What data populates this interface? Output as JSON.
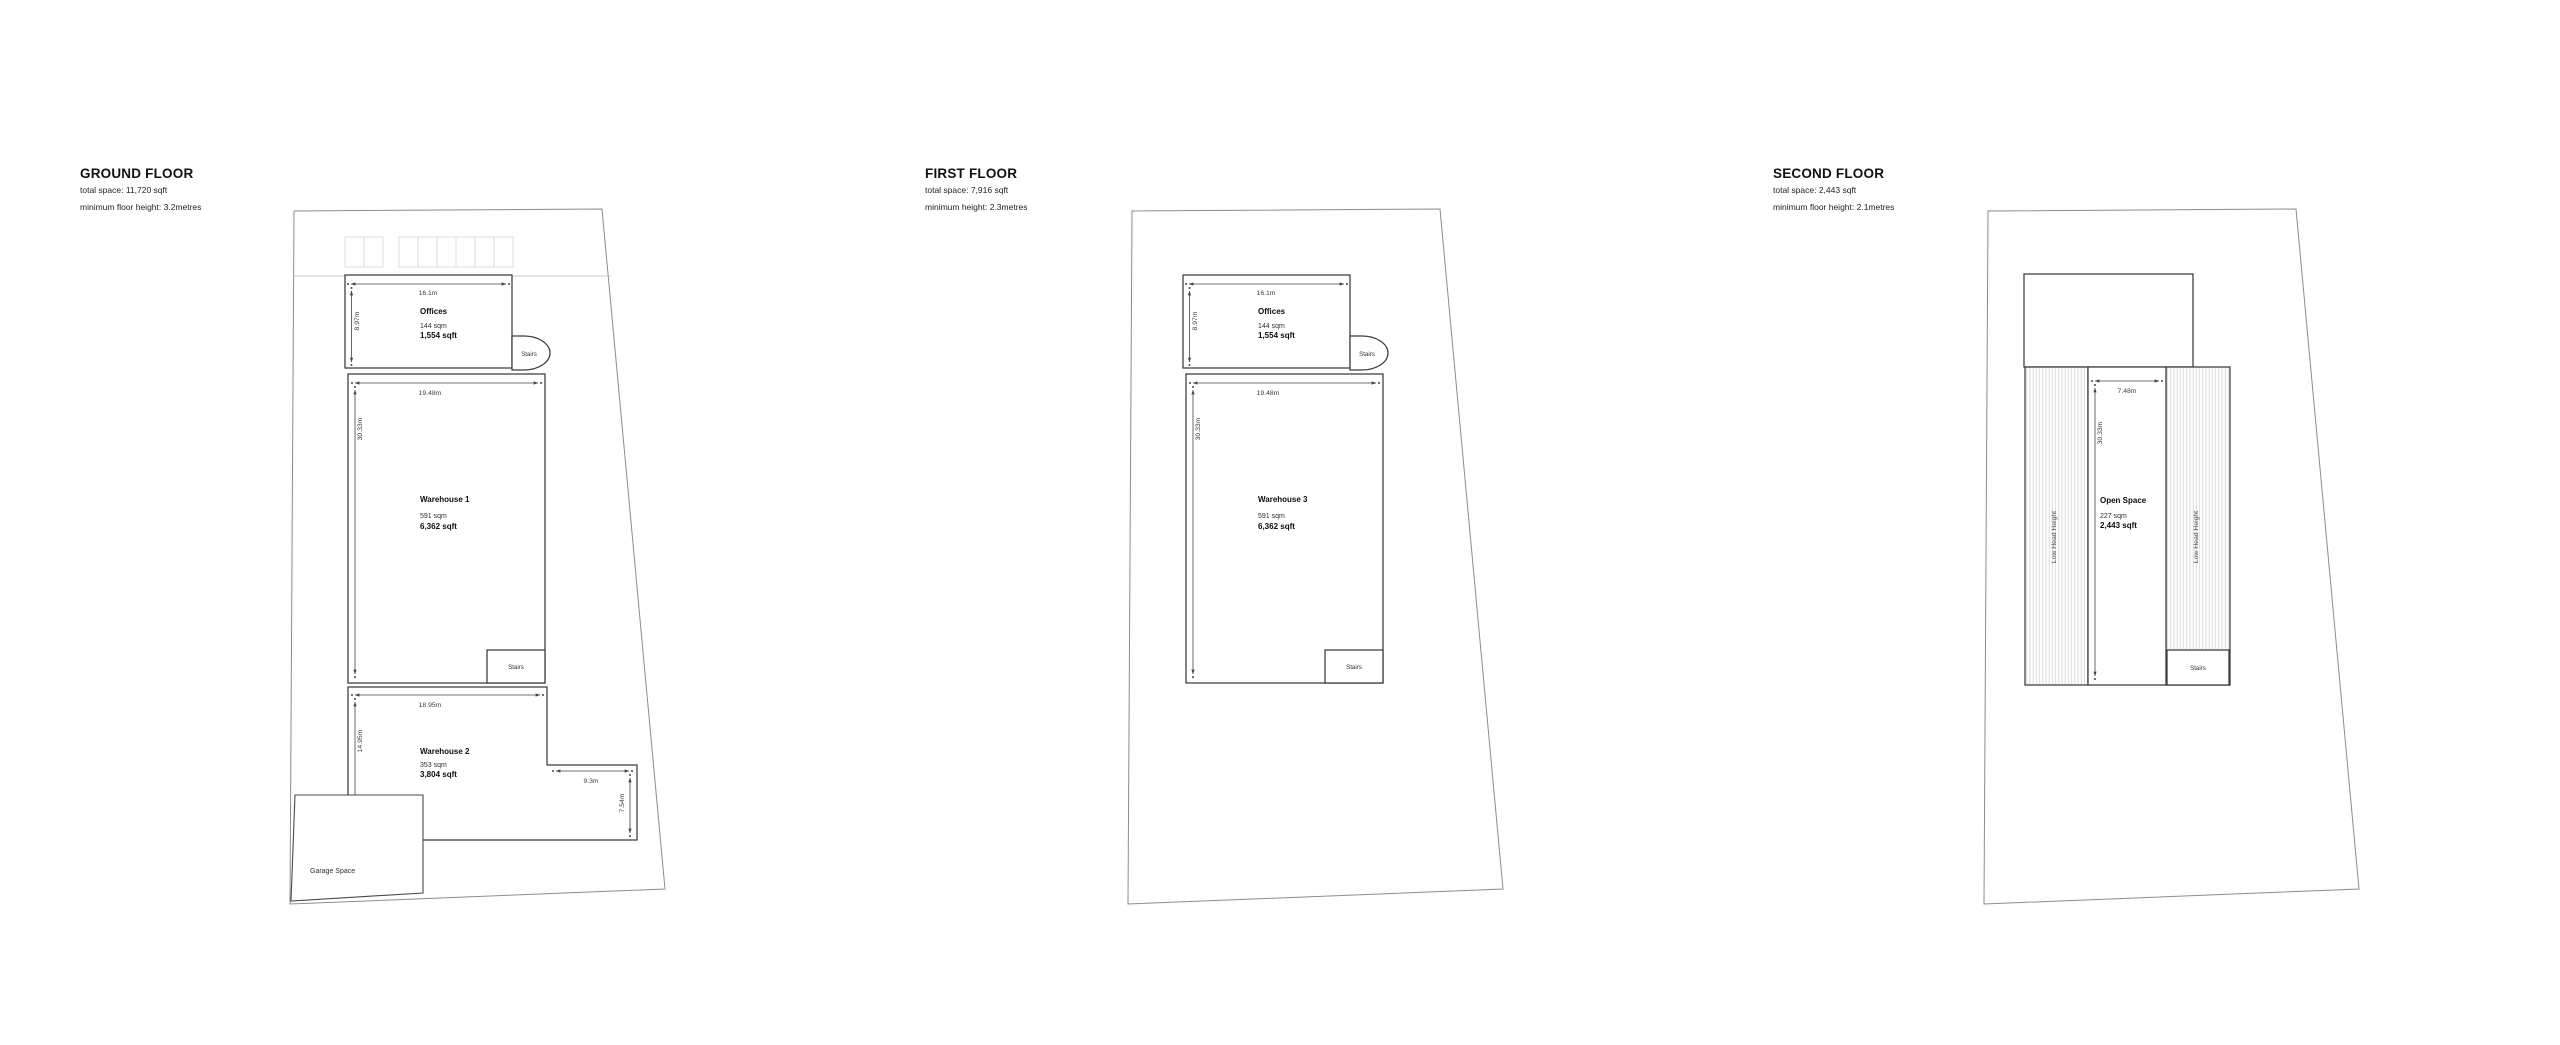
{
  "floors": [
    {
      "title": "GROUND FLOOR",
      "total_space": "total space: 11,720 sqft",
      "min_height": "minimum floor height: 3.2metres",
      "offices": {
        "name": "Offices",
        "sqm": "144 sqm",
        "sqft": "1,554 sqft",
        "width": "16.1m",
        "depth": "8.97m"
      },
      "warehouse1": {
        "name": "Warehouse 1",
        "sqm": "591 sqm",
        "sqft": "6,362 sqft",
        "width": "19.48m",
        "depth": "30.33m"
      },
      "warehouse2": {
        "name": "Warehouse 2",
        "sqm": "353 sqm",
        "sqft": "3,804 sqft",
        "width": "18.95m",
        "depth": "14.95m",
        "notch_width": "9.3m",
        "notch_depth": "7.54m"
      },
      "garage_label": "Garage Space",
      "stairs_label": "Stairs"
    },
    {
      "title": "FIRST FLOOR",
      "total_space": "total space: 7,916 sqft",
      "min_height": "minimum height: 2.3metres",
      "offices": {
        "name": "Offices",
        "sqm": "144 sqm",
        "sqft": "1,554 sqft",
        "width": "16.1m",
        "depth": "8.97m"
      },
      "warehouse3": {
        "name": "Warehouse 3",
        "sqm": "591 sqm",
        "sqft": "6,362 sqft",
        "width": "19.48m",
        "depth": "30.33m"
      },
      "stairs_label": "Stairs"
    },
    {
      "title": "SECOND FLOOR",
      "total_space": "total space: 2,443 sqft",
      "min_height": "minimum floor height: 2.1metres",
      "open_space": {
        "name": "Open Space",
        "sqm": "227 sqm",
        "sqft": "2,443 sqft",
        "width": "7.48m",
        "depth": "30.33m"
      },
      "low_head_label": "Low Head Height",
      "stairs_label": "Stairs"
    }
  ],
  "colors": {
    "wall_line": "#3a3a3a",
    "plot_line": "#8c8c8c",
    "dim_line": "#444444",
    "hatch": "#cfcfcf",
    "parking": "#dcdcdc"
  }
}
